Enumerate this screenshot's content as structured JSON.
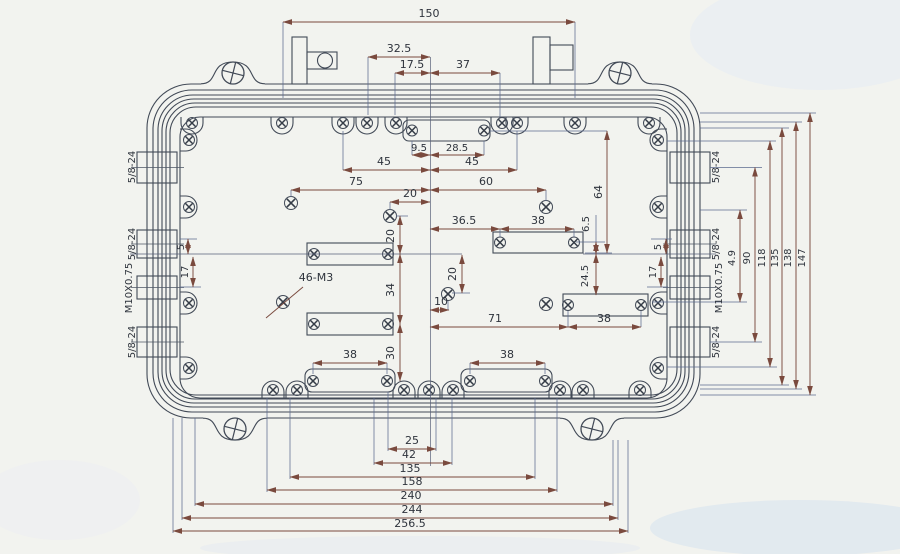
{
  "labels": {
    "thread_note": "46-M3",
    "port_left_1": "5/8-24",
    "port_left_2": "5/8-24",
    "port_left_3": "M10X0.75",
    "port_left_4": "5/8-24",
    "port_right_1": "5/8-24",
    "port_right_2": "5/8-24",
    "port_right_3": "M10X0.75",
    "port_right_4": "5/8-24"
  },
  "dims": {
    "overall_150": "150",
    "d32_5": "32.5",
    "d17_5": "17.5",
    "d37": "37",
    "d9_5": "9.5",
    "d28_5": "28.5",
    "d45_left": "45",
    "d45_right": "45",
    "d75": "75",
    "d60": "60",
    "d64": "64",
    "d20_top": "20",
    "d36_5": "36.5",
    "d38_right1": "38",
    "d6_5": "6.5",
    "d20_left": "20",
    "d34": "34",
    "d30": "30",
    "d20_mid": "20",
    "d10": "10",
    "d24_5": "24.5",
    "d71": "71",
    "d38_right2": "38",
    "d38_bottom_left": "38",
    "d38_bottom_right": "38",
    "d25": "25",
    "d42": "42",
    "d135_bottom": "135",
    "d158": "158",
    "d240": "240",
    "d244": "244",
    "d256_5": "256.5",
    "d4_9": "4.9",
    "d90": "90",
    "d118": "118",
    "d135_right": "135",
    "d138": "138",
    "d147": "147",
    "d5_left": "5",
    "d17_left": "17",
    "d5_right": "5",
    "d17_right": "17"
  }
}
